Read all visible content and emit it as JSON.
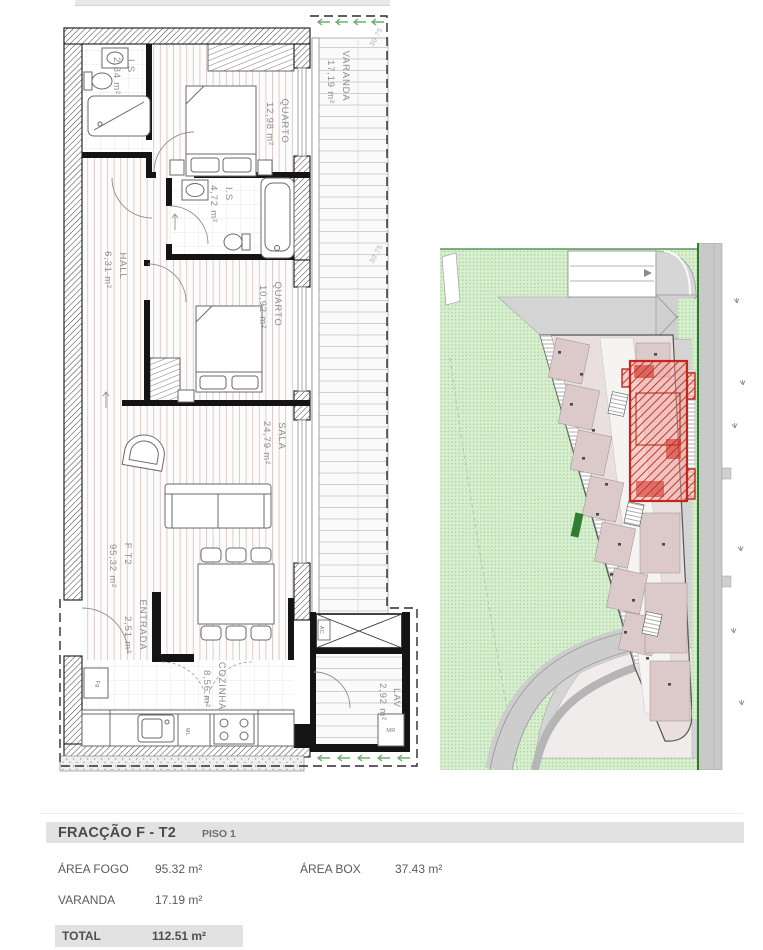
{
  "floorplan": {
    "rooms": [
      {
        "name": "I.S",
        "area": "2,84 m²"
      },
      {
        "name": "QUARTO",
        "area": "12,98 m²"
      },
      {
        "name": "I.S",
        "area": "4,72 m²"
      },
      {
        "name": "HALL",
        "area": "6,31 m²"
      },
      {
        "name": "QUARTO",
        "area": "10,92 m²"
      },
      {
        "name": "SALA",
        "area": "24,79 m²"
      },
      {
        "name": "F T2",
        "area": "95,32 m²"
      },
      {
        "name": "ENTRADA",
        "area": "2,51 m²"
      },
      {
        "name": "COZINHA",
        "area": "8,56 m²"
      },
      {
        "name": "VARANDA",
        "area": "17,19 m²"
      },
      {
        "name": "LAV",
        "area": "2,92 m²"
      }
    ],
    "equipment": {
      "fridge": "Fg",
      "washing_machine": "ML",
      "water_heater": "MR",
      "ac_shaft": "AC"
    },
    "levels": {
      "upper": "30.75",
      "lower": "30.75"
    }
  },
  "summary": {
    "title": "FRACÇÃO F - T2",
    "floor": "PISO 1",
    "area_fogo_label": "ÁREA FOGO",
    "area_fogo_value": "95.32 m²",
    "area_box_label": "ÁREA BOX",
    "area_box_value": "37.43 m²",
    "varanda_label": "VARANDA",
    "varanda_value": "17.19 m²",
    "total_label": "TOTAL",
    "total_value": "112.51 m²"
  }
}
